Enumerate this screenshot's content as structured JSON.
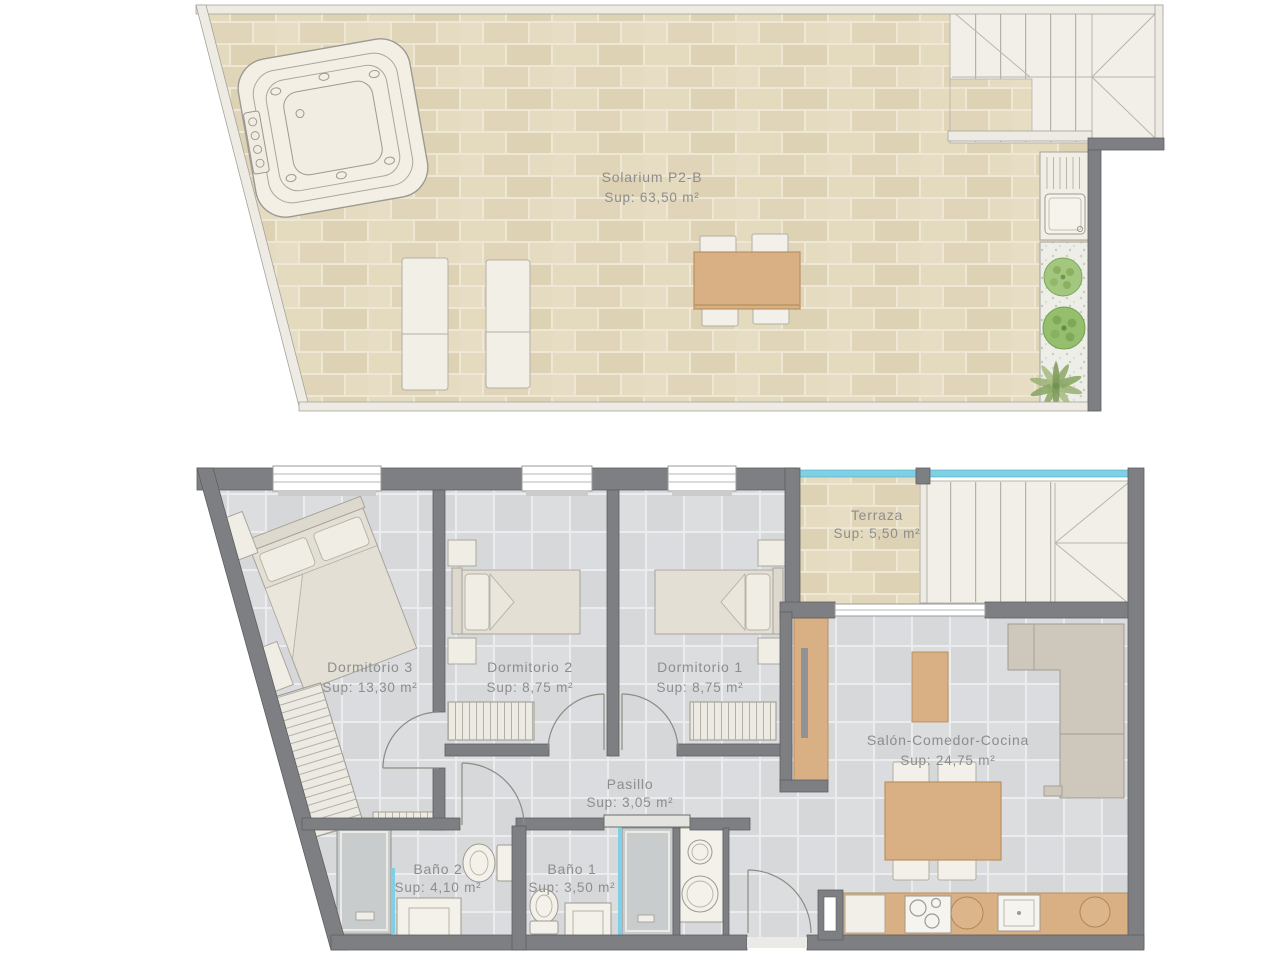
{
  "rooms": {
    "solarium": {
      "name": "Solarium P2-B",
      "area": "Sup: 63,50 m²"
    },
    "terraza": {
      "name": "Terraza",
      "area": "Sup: 5,50 m²"
    },
    "dormitorio3": {
      "name": "Dormitorio 3",
      "area": "Sup: 13,30 m²"
    },
    "dormitorio2": {
      "name": "Dormitorio 2",
      "area": "Sup: 8,75 m²"
    },
    "dormitorio1": {
      "name": "Dormitorio 1",
      "area": "Sup: 8,75 m²"
    },
    "salon": {
      "name": "Salón-Comedor-Cocina",
      "area": "Sup: 24,75 m²"
    },
    "pasillo": {
      "name": "Pasillo",
      "area": "Sup: 3,05 m²"
    },
    "bano2": {
      "name": "Baño 2",
      "area": "Sup: 4,10 m²"
    },
    "bano1": {
      "name": "Baño 1",
      "area": "Sup: 3,50 m²"
    }
  },
  "colors": {
    "wall_dark": "#7d7f82",
    "beige_tile": "#e2d8bc",
    "gray_tile": "#d8dadc",
    "wood": "#d8b084",
    "glass_cyan": "#7fd0e4",
    "label_text": "#8d8d8d"
  }
}
